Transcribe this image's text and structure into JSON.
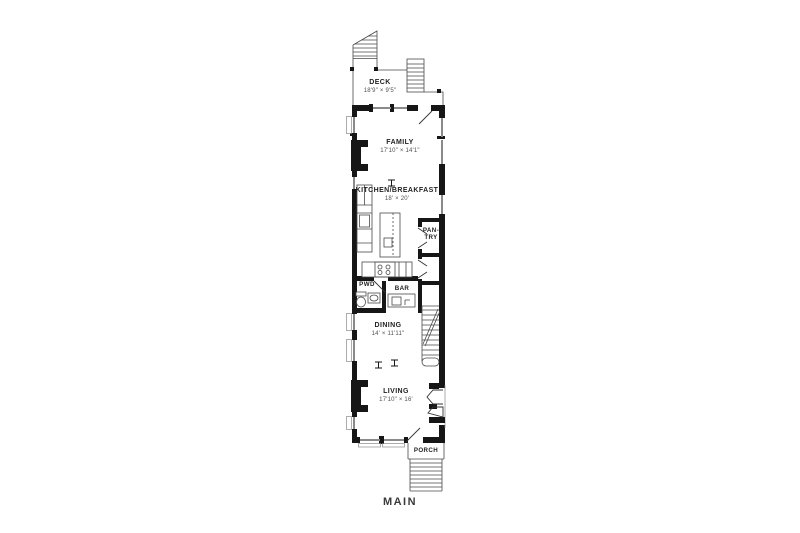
{
  "floor_label": "MAIN",
  "rooms": {
    "deck": {
      "name": "DECK",
      "dims": "18'9\" × 9'5\""
    },
    "family": {
      "name": "FAMILY",
      "dims": "17'10\" × 14'1\""
    },
    "kitchen": {
      "name": "KITCHEN/BREAKFAST",
      "dims": "18' × 20'"
    },
    "pantry": {
      "line1": "PAN-",
      "line2": "TRY"
    },
    "powder": {
      "name": "PWD"
    },
    "bar": {
      "name": "BAR"
    },
    "dining": {
      "name": "DINING",
      "dims": "14' × 11'11\""
    },
    "living": {
      "name": "LIVING",
      "dims": "17'10\" × 16'"
    },
    "porch": {
      "name": "PORCH"
    }
  },
  "colors": {
    "wall": "#161616",
    "line": "#4a4a4a",
    "window": "#8a8a8a",
    "door_line": "#333333",
    "text": "#1f1f1f",
    "dim_text": "#4f4f4f",
    "background": "#ffffff"
  }
}
